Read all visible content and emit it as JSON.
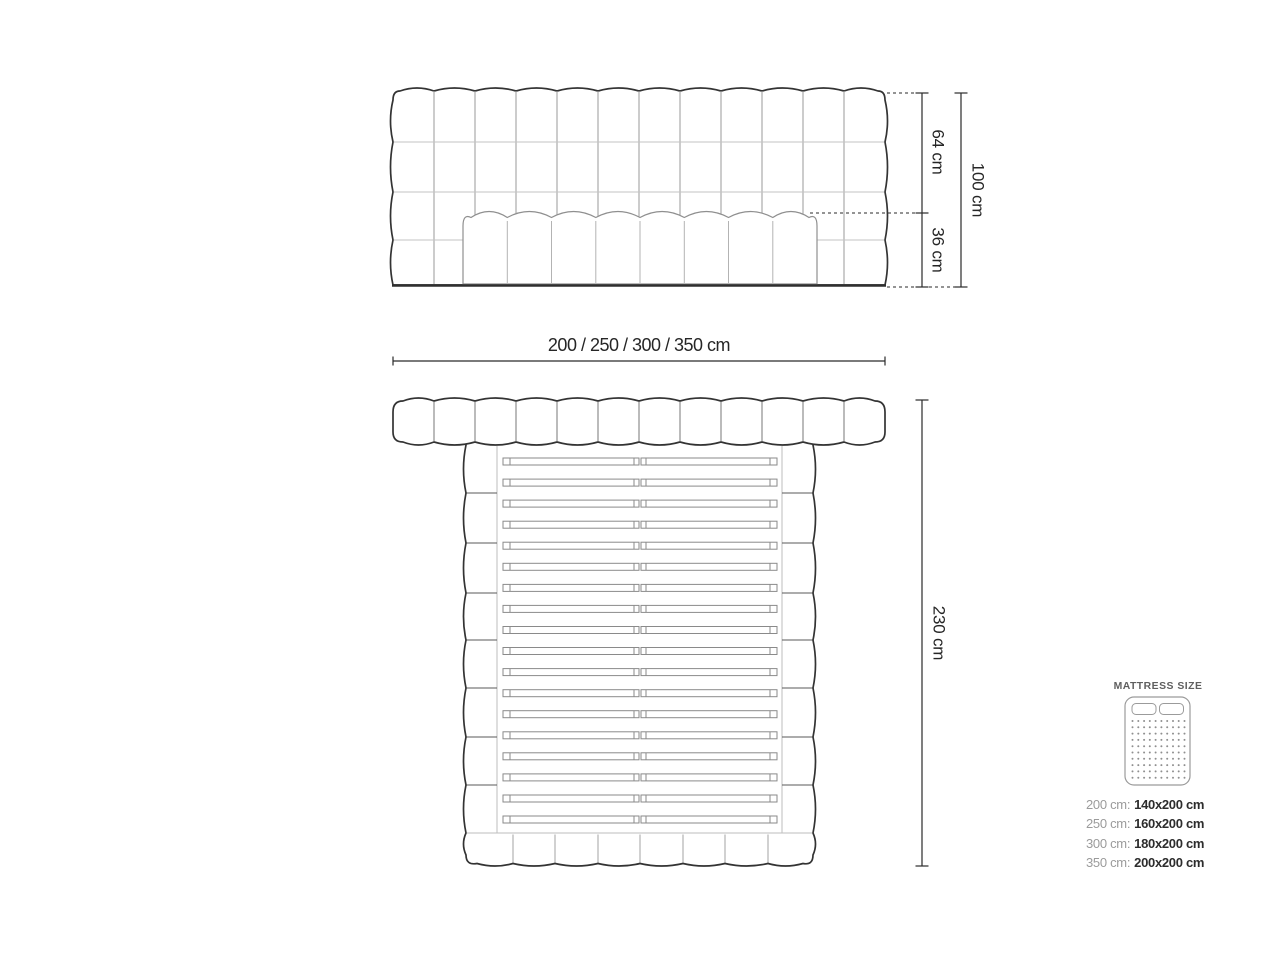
{
  "page": {
    "background": "#ffffff"
  },
  "front_view": {
    "dim_upper": "64 cm",
    "dim_lower": "36 cm",
    "dim_total": "100 cm"
  },
  "top_view": {
    "dim_width": "200 / 250 / 300 / 350 cm",
    "dim_depth": "230 cm"
  },
  "mattress_panel": {
    "title": "MATTRESS SIZE",
    "icon": "mattress-top-view-icon",
    "sizes": [
      {
        "label": "200 cm:",
        "value": "140x200 cm"
      },
      {
        "label": "250 cm:",
        "value": "160x200 cm"
      },
      {
        "label": "300 cm:",
        "value": "180x200 cm"
      },
      {
        "label": "350 cm:",
        "value": "200x200 cm"
      }
    ]
  },
  "colors": {
    "outline_dark": "#333333",
    "seam_light": "#c3c3c3",
    "seam_mid": "#9a9a9a",
    "slat": "#8a8a8a",
    "dimension": "#2a2a2a",
    "label_muted": "#9b9b9b",
    "label_dark": "#2d2d2d"
  }
}
